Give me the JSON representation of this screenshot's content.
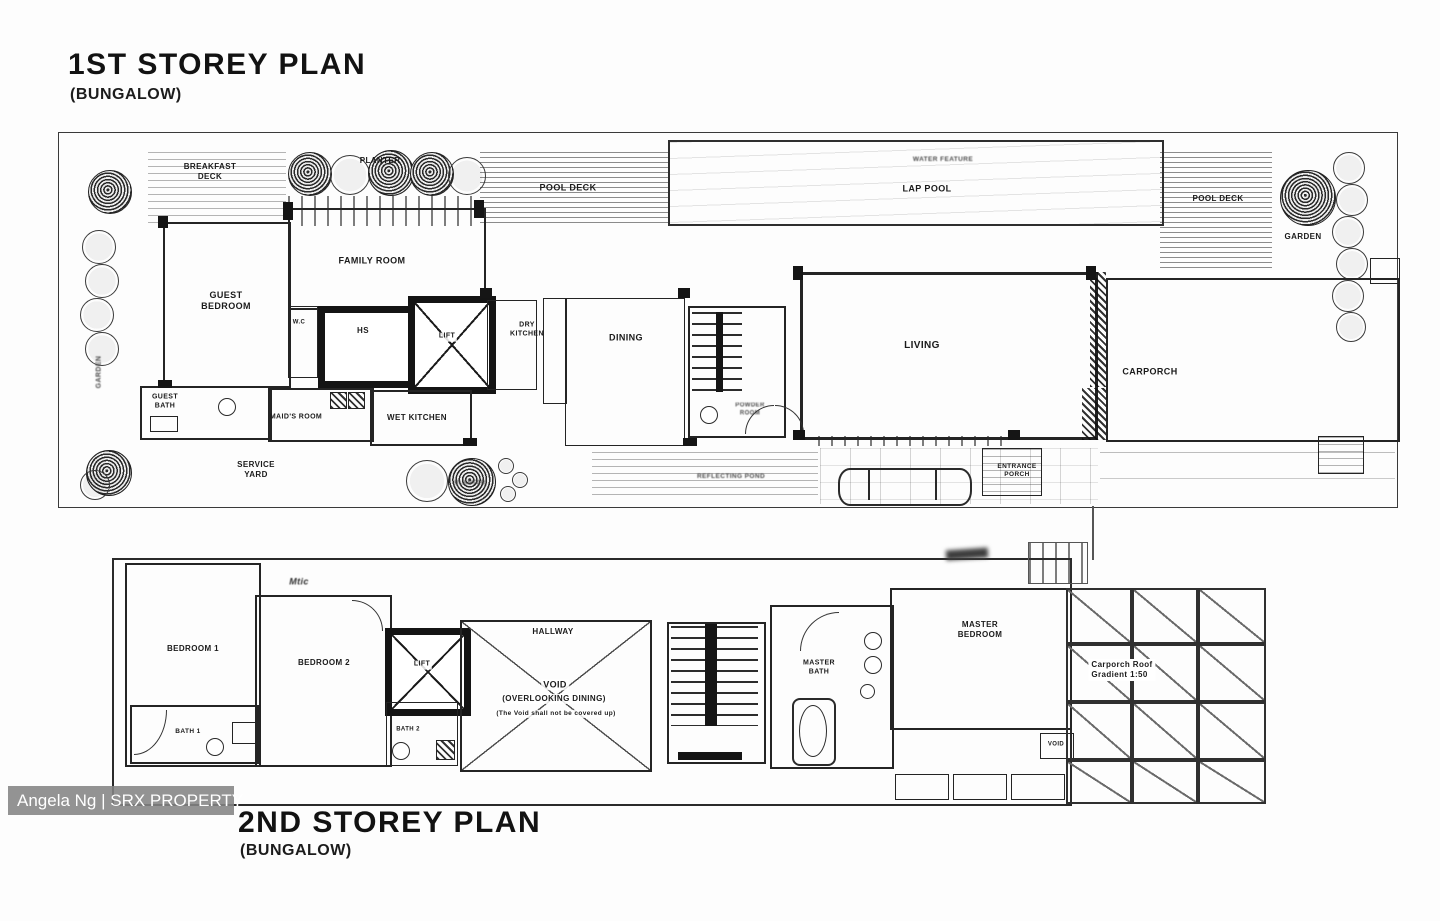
{
  "watermark": {
    "text": "Angela Ng | SRX PROPERTY"
  },
  "first_storey": {
    "title": "1ST STOREY PLAN",
    "subtitle": "(BUNGALOW)",
    "labels": {
      "breakfast_deck": "BREAKFAST\nDECK",
      "planter": "PLANTER",
      "pool_deck_left": "POOL DECK",
      "water_feature": "WATER FEATURE",
      "lap_pool": "LAP POOL",
      "pool_deck_right": "POOL DECK",
      "garden_right": "GARDEN",
      "garden_left": "GARDEN",
      "guest_bedroom": "GUEST\nBEDROOM",
      "family_room": "FAMILY ROOM",
      "wc": "W.C",
      "hs": "HS",
      "lift": "LIFT",
      "dry_kitchen": "DRY\nKITCHEN",
      "dining": "DINING",
      "powder_room": "POWDER\nROOM",
      "living": "LIVING",
      "carporch": "CARPORCH",
      "guest_bath": "GUEST\nBATH",
      "maids_room": "MAID'S ROOM",
      "wet_kitchen": "WET KITCHEN",
      "service_yard": "SERVICE\nYARD",
      "planter_small": "PLANTER",
      "reflecting_pond": "REFLECTING POND",
      "entrance_porch": "ENTRANCE\nPORCH"
    }
  },
  "second_storey": {
    "title": "2ND STOREY PLAN",
    "subtitle": "(BUNGALOW)",
    "labels": {
      "bedroom1": "BEDROOM 1",
      "bedroom2": "BEDROOM 2",
      "bath1": "BATH 1",
      "bath2": "BATH 2",
      "lift": "LIFT",
      "hallway": "HALLWAY",
      "void_title": "VOID",
      "void_subtitle": "(OVERLOOKING DINING)",
      "void_note": "(The Void shall not be covered up)",
      "master_bath": "MASTER\nBATH",
      "master_bedroom": "MASTER\nBEDROOM",
      "void_small": "VOID",
      "carporch_roof": "Carporch Roof\nGradient  1:50",
      "annotation": "Mtic"
    }
  }
}
